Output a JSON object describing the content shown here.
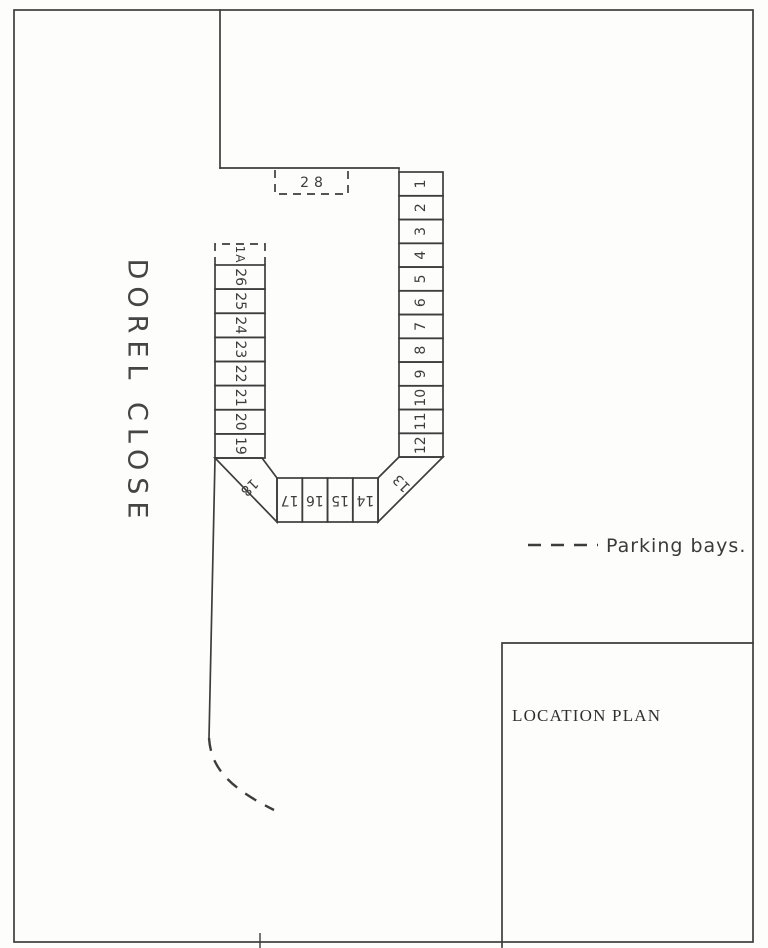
{
  "document": {
    "kind": "hand-drawn site plan (scanned)",
    "street_name": "DOREL CLOSE",
    "location_plan_label": "LOCATION PLAN"
  },
  "legend": {
    "symbol": "dashed-line",
    "label": "Parking bays."
  },
  "colors": {
    "paper": "#fdfdfb",
    "ink": "#3d3d3d"
  },
  "bays": {
    "right_column_top_to_bottom": [
      "1",
      "2",
      "3",
      "4",
      "5",
      "6",
      "7",
      "8",
      "9",
      "10",
      "11",
      "12"
    ],
    "corner_right": "13",
    "bottom_row_left_to_right": [
      "17",
      "16",
      "15",
      "14"
    ],
    "corner_left": "18",
    "left_column_top_to_bottom": [
      "26",
      "25",
      "24",
      "23",
      "22",
      "21",
      "20",
      "19"
    ],
    "dashed_bay_left": "1A",
    "dashed_bay_top": "28"
  }
}
